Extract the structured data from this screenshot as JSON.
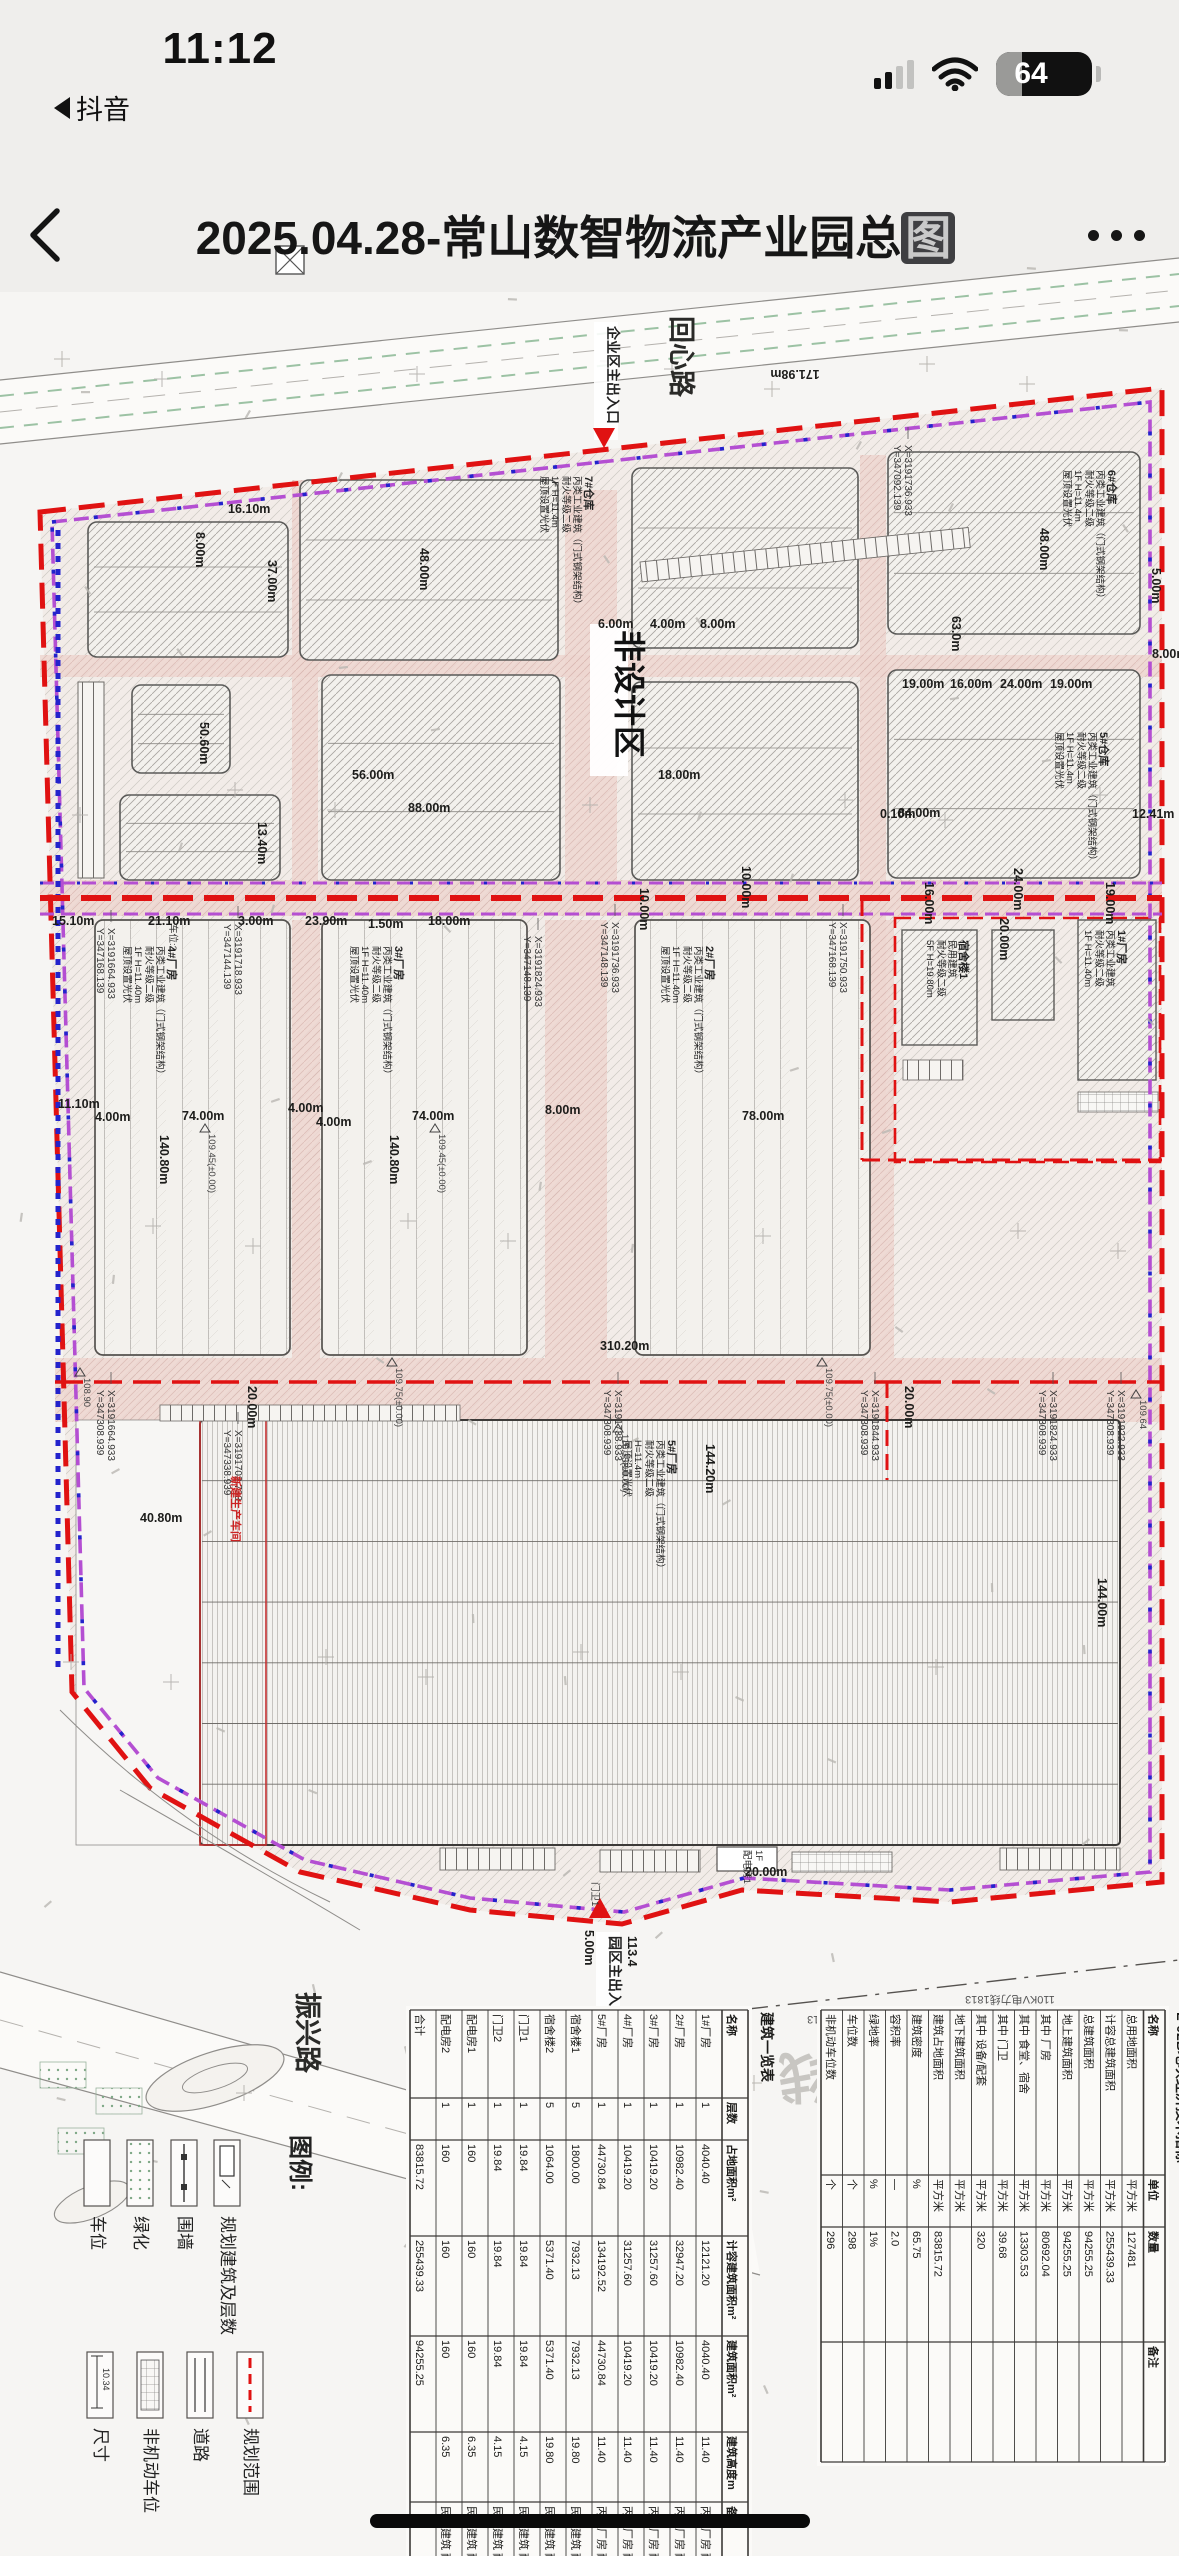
{
  "status_bar": {
    "time": "11:12",
    "back_app": "抖音",
    "battery_percent": "64"
  },
  "nav_bar": {
    "title_prefix": "2025.04.28-常山数智物流产业园总",
    "title_last_char": "图",
    "back_label": "back",
    "more_label": "more"
  },
  "plan": {
    "road_names": [
      {
        "t": "回心路",
        "x": 672,
        "y": 86
      },
      {
        "t": "振兴路",
        "x": 298,
        "y": 1762
      }
    ],
    "area_label": {
      "t": "非设计区",
      "x": 618,
      "y": 400
    },
    "entrances": [
      {
        "t": "企业区主出入口",
        "x": 608,
        "y": 96,
        "dir": "down",
        "ax": 604,
        "ay": 198
      },
      {
        "t": "园区主出入口",
        "x": 610,
        "y": 1706,
        "dir": "up",
        "ax": 600,
        "ay": 1688
      }
    ],
    "watermark": {
      "t": "110KV电力线",
      "x": 940,
      "y": 1828
    },
    "power_labels": [
      {
        "t": "110KV电力线1813",
        "x": 852,
        "y": 1786
      },
      {
        "t": "110KV电力线1813",
        "x": 1010,
        "y": 1766
      }
    ],
    "small_labels": [
      {
        "t": "配电房1",
        "x": 744,
        "y": 1620,
        "r": 90
      },
      {
        "t": "1F",
        "x": 756,
        "y": 1620,
        "r": 90
      },
      {
        "t": "门卫1",
        "x": 592,
        "y": 1652,
        "r": 90
      },
      {
        "t": "车位:2",
        "x": 170,
        "y": 694,
        "r": 90
      }
    ],
    "dims": [
      {
        "t": "16.10m",
        "x": 228,
        "y": 283,
        "r": 0
      },
      {
        "t": "8.00m",
        "x": 196,
        "y": 302,
        "r": 90
      },
      {
        "t": "6.00m",
        "x": 598,
        "y": 398,
        "r": 0
      },
      {
        "t": "4.00m",
        "x": 650,
        "y": 398,
        "r": 0
      },
      {
        "t": "8.00m",
        "x": 700,
        "y": 398,
        "r": 0
      },
      {
        "t": "8.00m",
        "x": 1152,
        "y": 428,
        "r": 0
      },
      {
        "t": "37.00m",
        "x": 268,
        "y": 330,
        "r": 90
      },
      {
        "t": "56.00m",
        "x": 352,
        "y": 549,
        "r": 0
      },
      {
        "t": "18.00m",
        "x": 658,
        "y": 549,
        "r": 0
      },
      {
        "t": "13.40m",
        "x": 258,
        "y": 592,
        "r": 90
      },
      {
        "t": "48.00m",
        "x": 420,
        "y": 318,
        "r": 90
      },
      {
        "t": "48.00m",
        "x": 1040,
        "y": 298,
        "r": 90
      },
      {
        "t": "20.00m",
        "x": 1000,
        "y": 688,
        "r": 90
      },
      {
        "t": "84.00m",
        "x": 898,
        "y": 587,
        "r": 0
      },
      {
        "t": "88.00m",
        "x": 408,
        "y": 582,
        "r": 0
      },
      {
        "t": "15.10m",
        "x": 52,
        "y": 695,
        "r": 0
      },
      {
        "t": "21.10m",
        "x": 148,
        "y": 695,
        "r": 0
      },
      {
        "t": "3.00m",
        "x": 238,
        "y": 695,
        "r": 0
      },
      {
        "t": "23.90m",
        "x": 305,
        "y": 695,
        "r": 0
      },
      {
        "t": "1.50m",
        "x": 368,
        "y": 698,
        "r": 0
      },
      {
        "t": "18.00m",
        "x": 428,
        "y": 695,
        "r": 0
      },
      {
        "t": "50.60m",
        "x": 200,
        "y": 492,
        "r": 90
      },
      {
        "t": "74.00m",
        "x": 182,
        "y": 890,
        "r": 0
      },
      {
        "t": "74.00m",
        "x": 412,
        "y": 890,
        "r": 0
      },
      {
        "t": "78.00m",
        "x": 742,
        "y": 890,
        "r": 0
      },
      {
        "t": "140.80m",
        "x": 160,
        "y": 905,
        "r": 90
      },
      {
        "t": "140.80m",
        "x": 390,
        "y": 905,
        "r": 90
      },
      {
        "t": "4.00m",
        "x": 288,
        "y": 882,
        "r": 0
      },
      {
        "t": "4.00m",
        "x": 316,
        "y": 896,
        "r": 0
      },
      {
        "t": "8.00m",
        "x": 545,
        "y": 884,
        "r": 0
      },
      {
        "t": "11.10m",
        "x": 58,
        "y": 878,
        "r": 0
      },
      {
        "t": "4.00m",
        "x": 95,
        "y": 891,
        "r": 0
      },
      {
        "t": "19.00m",
        "x": 902,
        "y": 458,
        "r": 0
      },
      {
        "t": "16.00m",
        "x": 950,
        "y": 458,
        "r": 0
      },
      {
        "t": "24.00m",
        "x": 1000,
        "y": 458,
        "r": 0
      },
      {
        "t": "19.00m",
        "x": 1050,
        "y": 458,
        "r": 0
      },
      {
        "t": "63.0m",
        "x": 952,
        "y": 386,
        "r": 90
      },
      {
        "t": "16.00m",
        "x": 925,
        "y": 652,
        "r": 90
      },
      {
        "t": "24.00m",
        "x": 1014,
        "y": 638,
        "r": 90
      },
      {
        "t": "19.00m",
        "x": 1106,
        "y": 652,
        "r": 90
      },
      {
        "t": "310.20m",
        "x": 600,
        "y": 1120,
        "r": 0
      },
      {
        "t": "20.00m",
        "x": 248,
        "y": 1156,
        "r": 90
      },
      {
        "t": "20.00m",
        "x": 905,
        "y": 1156,
        "r": 90
      },
      {
        "t": "10.00m",
        "x": 742,
        "y": 636,
        "r": 90
      },
      {
        "t": "10.00m",
        "x": 640,
        "y": 658,
        "r": 90
      },
      {
        "t": "144.20m",
        "x": 706,
        "y": 1214,
        "r": 90
      },
      {
        "t": "144.00m",
        "x": 1098,
        "y": 1348,
        "r": 90
      },
      {
        "t": "40.80m",
        "x": 140,
        "y": 1292,
        "r": 0
      },
      {
        "t": "12.41m",
        "x": 1132,
        "y": 588,
        "r": 0
      },
      {
        "t": "0.10m",
        "x": 880,
        "y": 588,
        "r": 0
      },
      {
        "t": "5.00m",
        "x": 1152,
        "y": 338,
        "r": 90
      },
      {
        "t": "5.00m",
        "x": 585,
        "y": 1700,
        "r": 90
      },
      {
        "t": "20.00m",
        "x": 745,
        "y": 1646,
        "r": 0
      },
      {
        "t": "171.98m",
        "x": 795,
        "y": 140,
        "r": 180
      },
      {
        "t": "151.42m",
        "x": 662,
        "y": 1820,
        "r": 180
      },
      {
        "t": "113.4",
        "x": 628,
        "y": 1706,
        "r": 90
      }
    ],
    "coords": [
      {
        "x": 905,
        "y": 215,
        "a": "X=3191736.933",
        "b": "Y=347092.139"
      },
      {
        "x": 108,
        "y": 698,
        "a": "X=3191664.933",
        "b": "Y=347168.139"
      },
      {
        "x": 235,
        "y": 694,
        "a": "X=3191718.933",
        "b": "Y=347144.139"
      },
      {
        "x": 612,
        "y": 692,
        "a": "X=3191736.933",
        "b": "Y=347148.139"
      },
      {
        "x": 840,
        "y": 692,
        "a": "X=3191750.933",
        "b": "Y=347168.139"
      },
      {
        "x": 535,
        "y": 706,
        "a": "X=3191824.933",
        "b": "Y=347148.139"
      },
      {
        "x": 108,
        "y": 1160,
        "a": "X=3191664.933",
        "b": "Y=347308.939"
      },
      {
        "x": 615,
        "y": 1160,
        "a": "X=3191738.933",
        "b": "Y=347308.939"
      },
      {
        "x": 872,
        "y": 1160,
        "a": "X=3191844.933",
        "b": "Y=347308.939"
      },
      {
        "x": 1050,
        "y": 1160,
        "a": "X=3191824.933",
        "b": "Y=347308.939"
      },
      {
        "x": 1118,
        "y": 1160,
        "a": "X=3191922.933",
        "b": "Y=347308.939"
      },
      {
        "x": 235,
        "y": 1200,
        "a": "X=3191702.733",
        "b": "Y=347338.939"
      }
    ],
    "annotations": [
      {
        "x": 585,
        "y": 246,
        "lines": [
          "7#仓库",
          "丙类工业建筑（门式钢架结构）",
          "耐火等级二级",
          "1F  H=11.4m",
          "屋顶设置光伏"
        ]
      },
      {
        "x": 1108,
        "y": 240,
        "lines": [
          "6#仓库",
          "丙类工业建筑（门式钢架结构）",
          "耐火等级二级",
          "1F  H=11.4m",
          "屋顶设置光伏"
        ]
      },
      {
        "x": 1100,
        "y": 502,
        "lines": [
          "5#仓库",
          "丙类工业建筑（门式钢架结构）",
          "耐火等级二级",
          "1F  H=11.4m",
          "屋顶设置光伏"
        ]
      },
      {
        "x": 168,
        "y": 716,
        "lines": [
          "4#厂房",
          "丙类工业建筑（门式钢架结构）",
          "耐火等级二级",
          "1F  H=11.40m",
          "屋顶设置光伏"
        ]
      },
      {
        "x": 395,
        "y": 716,
        "lines": [
          "3#厂房",
          "丙类工业建筑（门式钢架结构）",
          "耐火等级二级",
          "1F  H=11.40m",
          "屋顶设置光伏"
        ]
      },
      {
        "x": 706,
        "y": 716,
        "lines": [
          "2#厂房",
          "丙类工业建筑（门式钢架结构）",
          "耐火等级二级",
          "1F  H=11.40m",
          "屋顶设置光伏"
        ]
      },
      {
        "x": 668,
        "y": 1210,
        "lines": [
          "5#厂房",
          "丙类工业建筑（门式钢架结构）",
          "耐火等级二级",
          "H=11.4m",
          "屋顶设置光伏"
        ]
      },
      {
        "x": 960,
        "y": 710,
        "lines": [
          "宿舍楼1",
          "民用建筑",
          "耐火等级二级",
          "5F  H=19.80m"
        ]
      },
      {
        "x": 1118,
        "y": 700,
        "lines": [
          "1#厂房",
          "丙类工业建筑",
          "耐火等级二级",
          "1F  H=11.40m"
        ]
      },
      {
        "x": 232,
        "y": 1246,
        "lines": [
          "新建生产车间"
        ],
        "color": "#c22"
      }
    ],
    "elevations": [
      {
        "t": "109.75(±0.00)",
        "x": 392,
        "y": 1136
      },
      {
        "t": "109.75(±0.00)",
        "x": 822,
        "y": 1136
      },
      {
        "t": "109.45(±0.00)",
        "x": 205,
        "y": 902
      },
      {
        "t": "109.45(±0.00)",
        "x": 435,
        "y": 902
      },
      {
        "t": "110.35(±0.00)",
        "x": 618,
        "y": 1202
      },
      {
        "t": "108.90",
        "x": 80,
        "y": 1146
      },
      {
        "t": "109.64",
        "x": 1136,
        "y": 1168
      }
    ],
    "legend": {
      "title": "图例:",
      "row1": [
        {
          "label": "车位",
          "sym": "plain",
          "x": 110
        },
        {
          "label": "绿化",
          "sym": "dots",
          "x": 153
        },
        {
          "label": "围墙",
          "sym": "wall",
          "x": 197
        },
        {
          "label": "规划建筑及层数",
          "sym": "bldg",
          "x": 240
        }
      ],
      "row2": [
        {
          "label": "尺寸",
          "sym": "dim",
          "x": 113,
          "dimtext": "10.34"
        },
        {
          "label": "非机动车位",
          "sym": "grid",
          "x": 163
        },
        {
          "label": "道路",
          "sym": "road",
          "x": 213
        },
        {
          "label": "规划范围",
          "sym": "redline",
          "x": 263
        }
      ]
    },
    "tables": {
      "indicators": {
        "title": "L-02B地块经济技术指标",
        "headers": [
          "名称",
          "单位",
          "数量",
          "备注"
        ],
        "rows": [
          [
            "总用地面积",
            "平方米",
            "127481",
            ""
          ],
          [
            "计容总建筑面积",
            "平方米",
            "255439.33",
            ""
          ],
          [
            "总建筑面积",
            "平方米",
            "94255.25",
            ""
          ],
          [
            "地上建筑面积",
            "平方米",
            "94255.25",
            ""
          ],
          [
            "其中 厂房",
            "平方米",
            "80692.04",
            ""
          ],
          [
            "其中 食堂、宿舍",
            "平方米",
            "13303.53",
            ""
          ],
          [
            "其中 门卫",
            "平方米",
            "39.68",
            ""
          ],
          [
            "其中 设备/配套",
            "平方米",
            "320",
            ""
          ],
          [
            "地下建筑面积",
            "平方米",
            "",
            ""
          ],
          [
            "建筑占地面积",
            "平方米",
            "83815.72",
            ""
          ],
          [
            "建筑密度",
            "%",
            "65.75",
            ""
          ],
          [
            "容积率",
            "—",
            "2.0",
            ""
          ],
          [
            "绿地率",
            "%",
            "1%",
            ""
          ],
          [
            "车位数",
            "个",
            "298",
            ""
          ],
          [
            "非机动车位数",
            "个",
            "296",
            ""
          ]
        ]
      },
      "buildings": {
        "title": "建筑一览表",
        "headers": [
          "名称",
          "层数",
          "占地面积m²",
          "计容建筑面积m²",
          "建筑面积m²",
          "建筑高度m",
          "备注"
        ],
        "rows": [
          [
            "1#厂房",
            "1",
            "4040.40",
            "12121.20",
            "4040.40",
            "11.40",
            "丙类厂房 耐火等级二级"
          ],
          [
            "2#厂房",
            "1",
            "10982.40",
            "32947.20",
            "10982.40",
            "11.40",
            "丙类厂房 耐火等级二级"
          ],
          [
            "3#厂房",
            "1",
            "10419.20",
            "31257.60",
            "10419.20",
            "11.40",
            "丙类厂房 耐火等级二级"
          ],
          [
            "4#厂房",
            "1",
            "10419.20",
            "31257.60",
            "10419.20",
            "11.40",
            "丙类厂房 耐火等级二级"
          ],
          [
            "5#厂房",
            "1",
            "44730.84",
            "134192.52",
            "44730.84",
            "11.40",
            "丙类厂房 耐火等级二级"
          ],
          [
            "宿舍楼1",
            "5",
            "1800.00",
            "7932.13",
            "7932.13",
            "19.80",
            "民用建筑 耐火等级二级"
          ],
          [
            "宿舍楼2",
            "5",
            "1064.00",
            "5371.40",
            "5371.40",
            "19.80",
            "民用建筑 耐火等级二级"
          ],
          [
            "门卫1",
            "1",
            "19.84",
            "19.84",
            "19.84",
            "4.15",
            "民用建筑 耐火等级二级"
          ],
          [
            "门卫2",
            "1",
            "19.84",
            "19.84",
            "19.84",
            "4.15",
            "民用建筑 耐火等级二级"
          ],
          [
            "配电房1",
            "1",
            "160",
            "160",
            "160",
            "6.35",
            "民用建筑 耐火等级二级"
          ],
          [
            "配电房2",
            "1",
            "160",
            "160",
            "160",
            "6.35",
            "民用建筑 耐火等级二级"
          ],
          [
            "合计",
            "",
            "83815.72",
            "255439.33",
            "94255.25",
            "",
            ""
          ]
        ]
      }
    },
    "colors": {
      "boundary_red": "#e01212",
      "purple": "#b44fd2",
      "blue": "#2323cc",
      "road_pink": "#eed7d1",
      "paper": "#f6f5f2",
      "ink": "#1d1d1b"
    }
  }
}
